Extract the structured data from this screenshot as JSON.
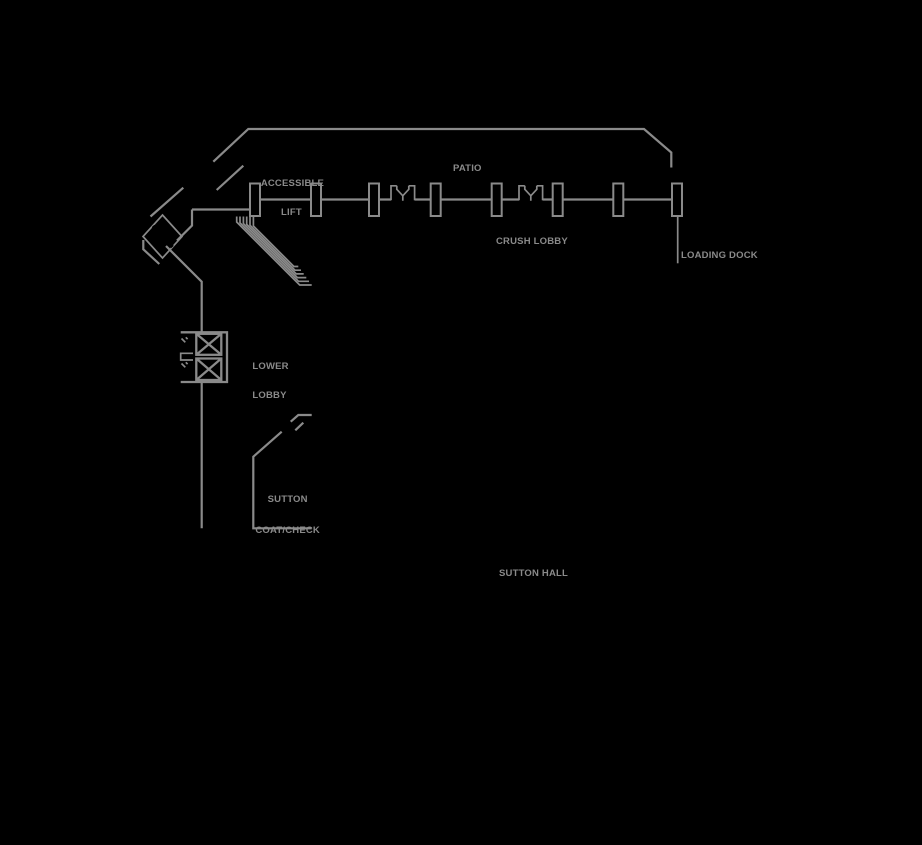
{
  "colors": {
    "background": "#000000",
    "line": "#8a8a8a",
    "text": "#8a8a8a"
  },
  "labels": {
    "accessible_lift": {
      "line1": "ACCESSIBLE",
      "line2": "LIFT"
    },
    "patio": "PATIO",
    "crush_lobby": "CRUSH LOBBY",
    "loading_dock": "LOADING DOCK",
    "lower_lobby": {
      "line1": "LOWER",
      "line2": "LOBBY"
    },
    "sutton_coatcheck": {
      "line1": "SUTTON",
      "line2": "COAT/CHECK"
    },
    "sutton_hall": "SUTTON HALL"
  },
  "glyphs": {
    "escalator": "hatched-diamond-band",
    "stairs": "nested-step-lines",
    "elevators": "crossed-box-pair",
    "doors": "double-door-y-symbol",
    "pillars": "rectangular-column-row"
  }
}
